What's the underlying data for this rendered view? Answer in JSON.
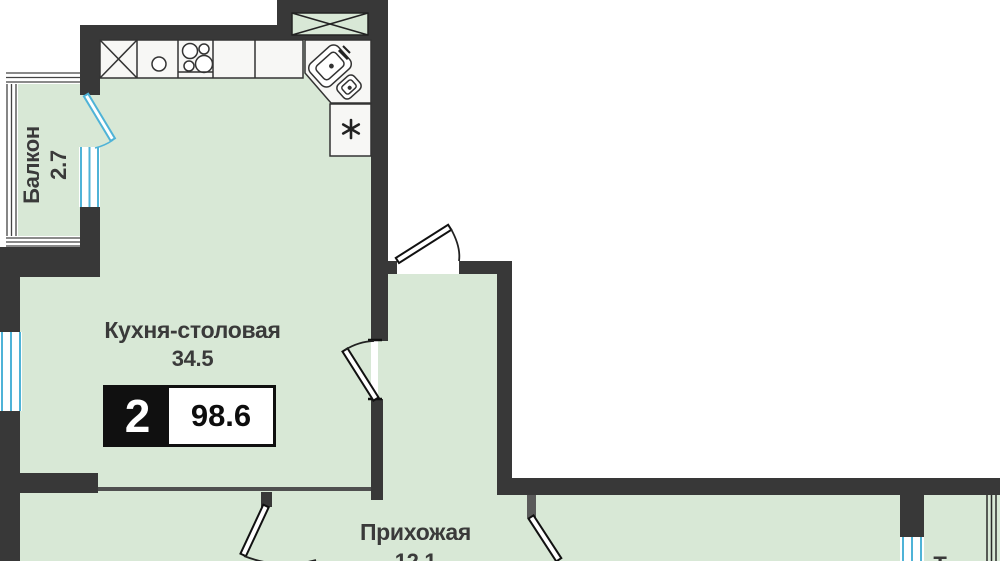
{
  "plan": {
    "badge": {
      "room_count": "2",
      "total_area": "98.6"
    },
    "rooms": {
      "kitchen": {
        "name": "Кухня-столовая",
        "area": "34.5"
      },
      "hallway": {
        "name": "Прихожая",
        "area": "12.1"
      },
      "balcony": {
        "name": "Балкон",
        "area": "2.7"
      },
      "partial": {
        "label": "Т"
      }
    },
    "fixtures": [
      "cabinet-x-cross",
      "sink-single-round",
      "stove-four-burners",
      "corner-double-sink-with-faucet",
      "dishwasher-asterisk",
      "vent-shaft-x-box"
    ],
    "colors": {
      "wall": "#383838",
      "room_fill": "#d8e8d6",
      "window_blue": "#4fb3d7",
      "outline": "#333333",
      "badge_black": "#101010",
      "background": "#ffffff"
    }
  }
}
